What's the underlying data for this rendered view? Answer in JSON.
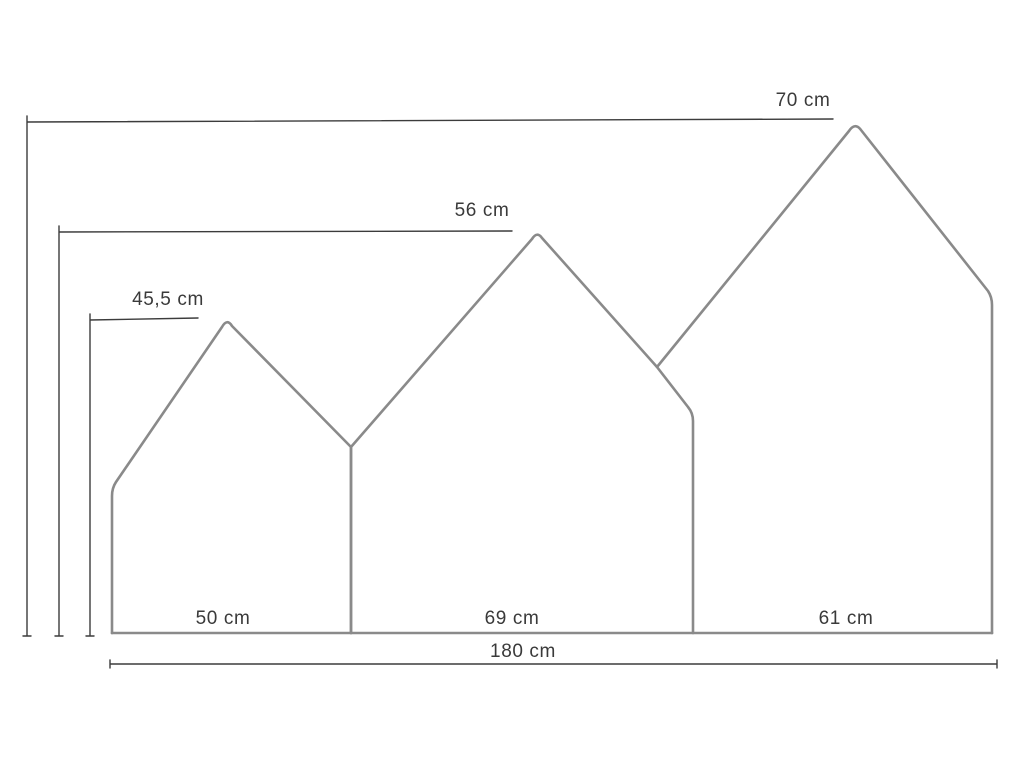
{
  "diagram": {
    "type": "dimension-drawing",
    "subject": "three-house headboard panels",
    "unit": "cm"
  },
  "labels": {
    "height_1": "45,5 cm",
    "height_2": "56 cm",
    "height_3": "70 cm",
    "width_1": "50 cm",
    "width_2": "69 cm",
    "width_3": "61 cm",
    "total_width": "180 cm"
  },
  "measurements": {
    "unit": "cm",
    "panels": [
      {
        "name": "left-house",
        "width_cm": 50,
        "height_cm": 45.5
      },
      {
        "name": "middle-house",
        "width_cm": 69,
        "height_cm": 56
      },
      {
        "name": "right-house",
        "width_cm": 61,
        "height_cm": 70
      }
    ],
    "total_width_cm": 180
  },
  "colors": {
    "background": "#ffffff",
    "house_outline": "#8a8a8a",
    "dimension_line": "#3c3c3c",
    "label_text": "#3a3a3a"
  }
}
